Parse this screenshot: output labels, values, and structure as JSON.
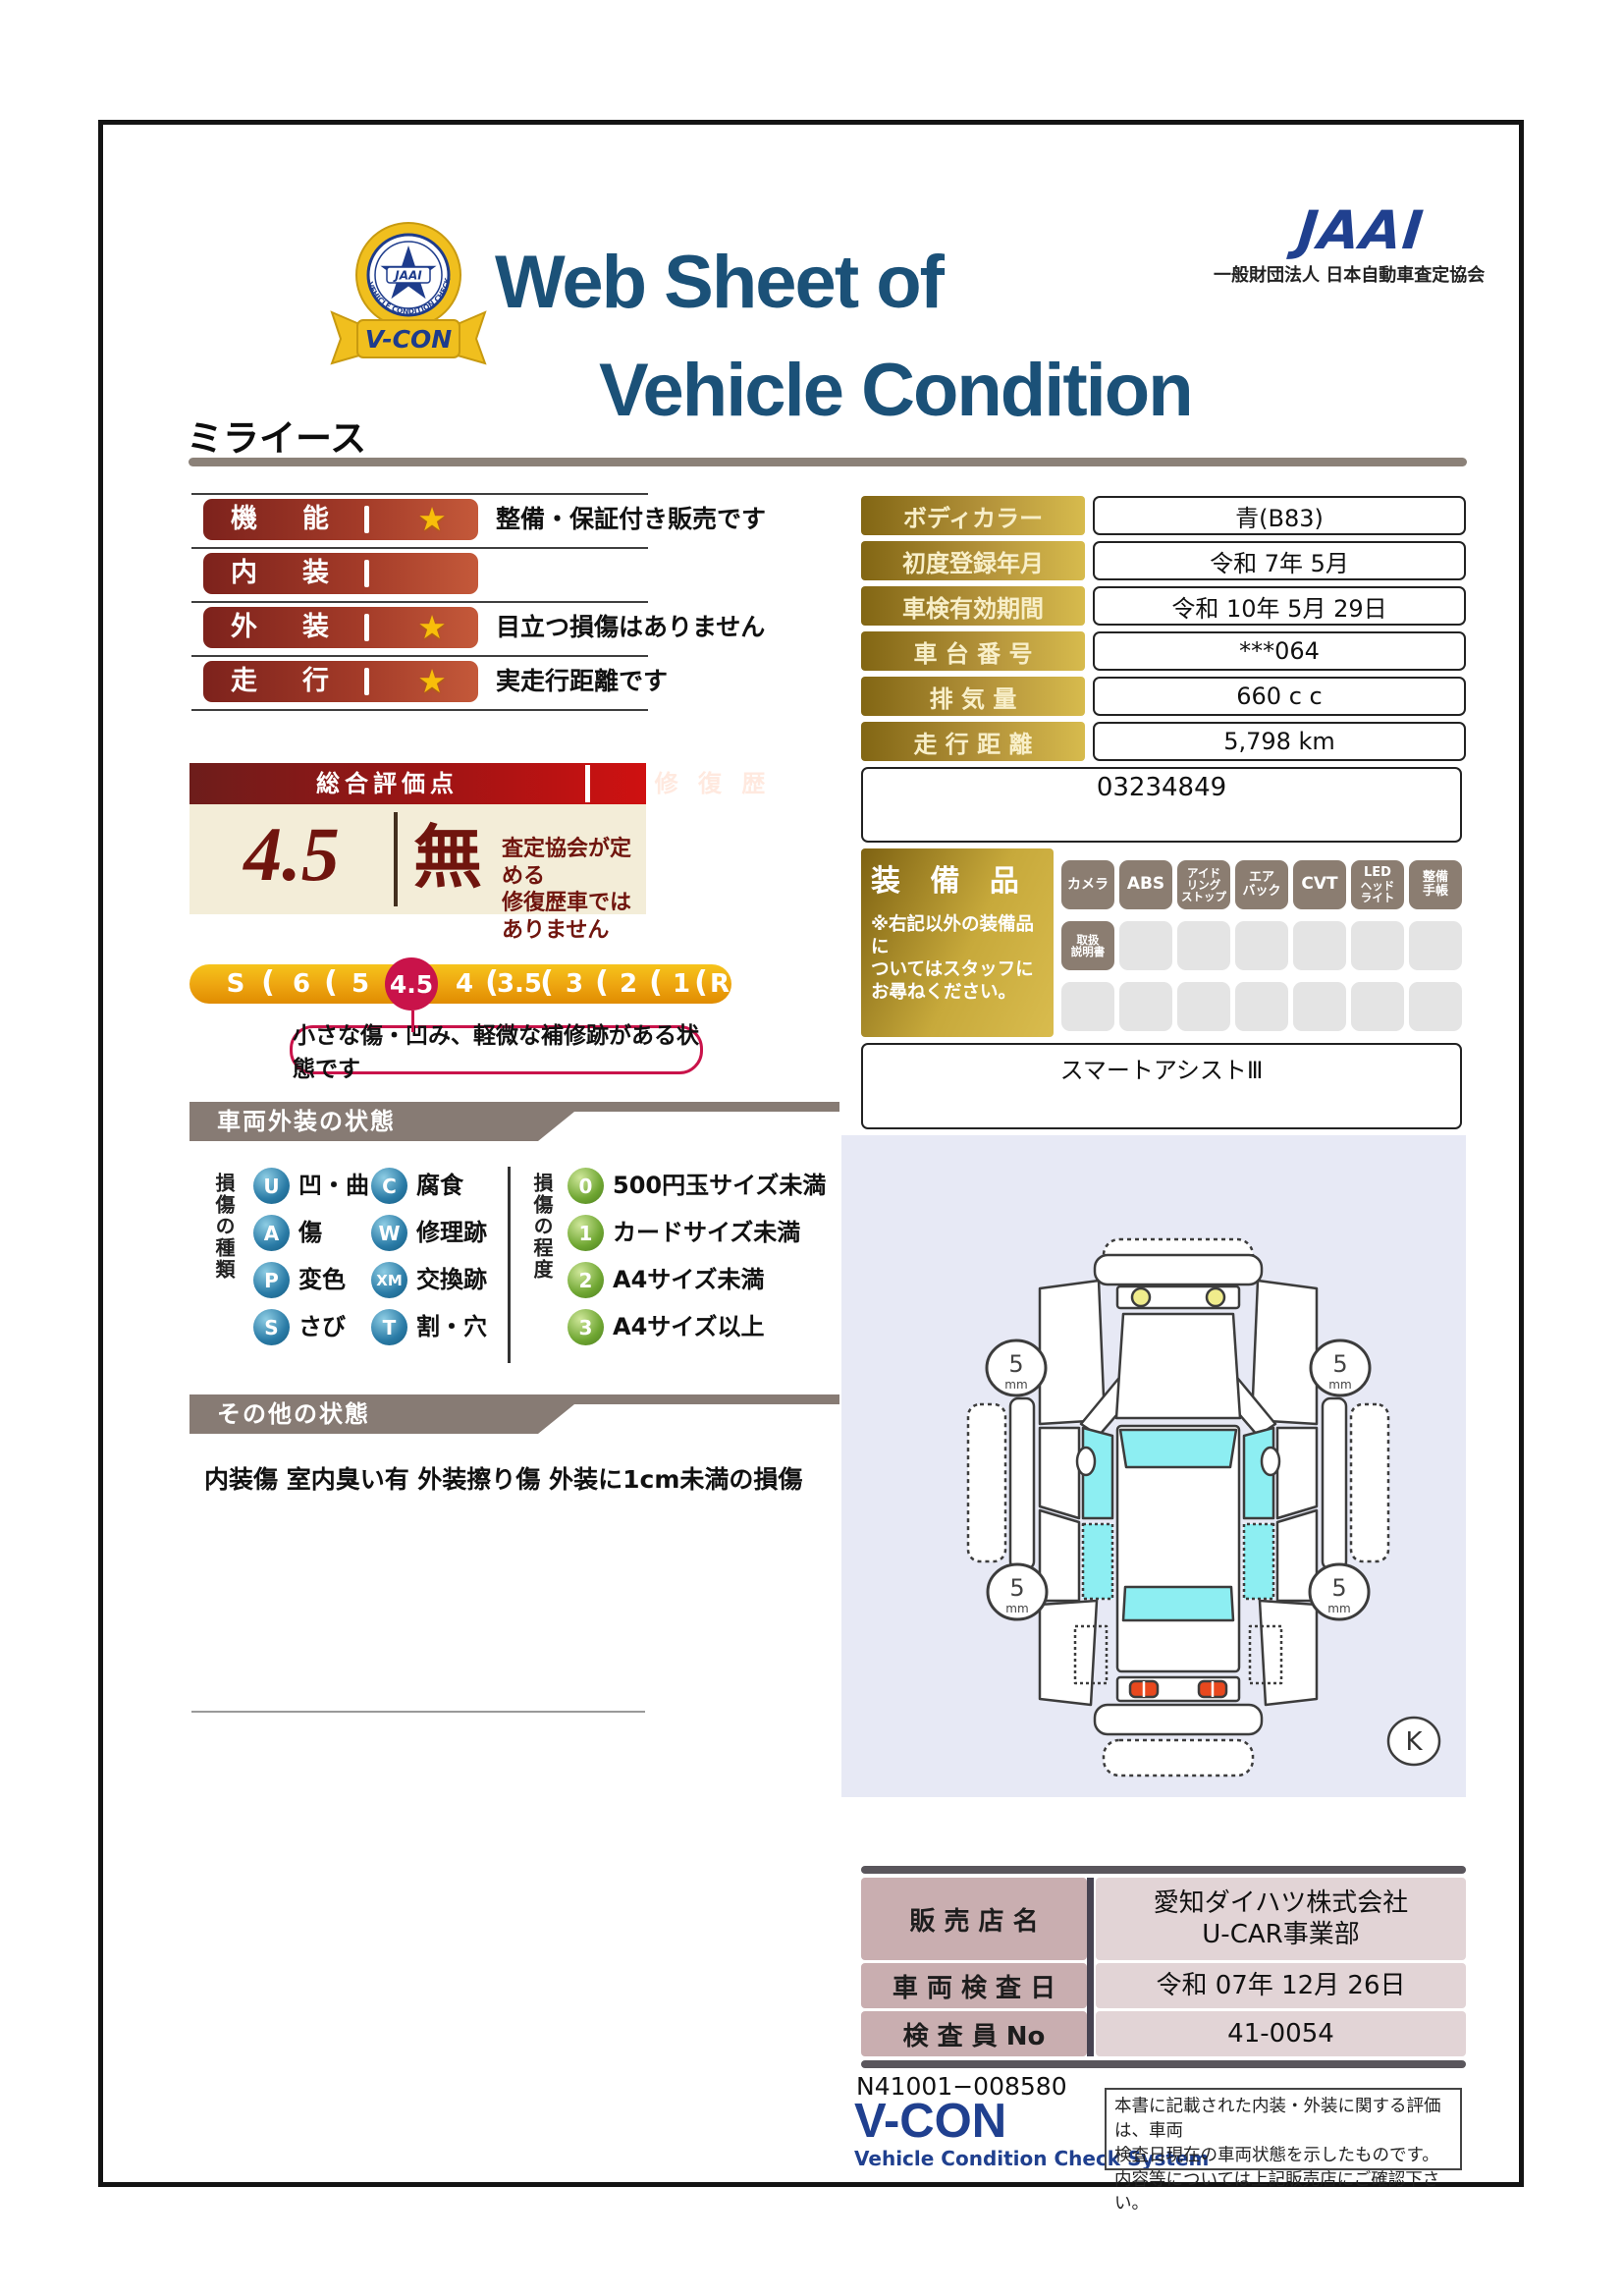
{
  "header": {
    "title_line1": "Web Sheet of",
    "title_line2": "Vehicle Condition",
    "jaai_logo": "JAAI",
    "jaai_org": "一般財団法人 日本自動車査定協会",
    "emblem": {
      "banner": "V-CON",
      "ring_text": "VEHICLE CONDITION CHECK SYSTEM",
      "center": "JAAI"
    }
  },
  "vehicle_name": "ミライース",
  "ratings": {
    "rows": [
      {
        "label": "機能",
        "star": "★",
        "note": "整備・保証付き販売です"
      },
      {
        "label": "内装",
        "star": "",
        "note": ""
      },
      {
        "label": "外装",
        "star": "★",
        "note": "目立つ損傷はありません"
      },
      {
        "label": "走行",
        "star": "★",
        "note": "実走行距離です"
      }
    ]
  },
  "overall": {
    "header_left": "総合評価点",
    "header_right": "修 復 歴",
    "score": "4.5",
    "repair_mark": "無",
    "repair_note1": "査定協会が定める",
    "repair_note2": "修復歴車ではありません",
    "scale": [
      "S",
      "6",
      "5",
      "4.5",
      "4",
      "3.5",
      "3",
      "2",
      "1",
      "R"
    ],
    "selected": "4.5",
    "callout": "小さな傷・凹み、軽微な補修跡がある状態です"
  },
  "info": {
    "rows": [
      {
        "label": "ボディカラー",
        "value": "青(B83)"
      },
      {
        "label": "初度登録年月",
        "value": "令和 7年 5月"
      },
      {
        "label": "車検有効期間",
        "value": "令和 10年 5月 29日"
      },
      {
        "label": "車 台 番 号",
        "value": "***064"
      },
      {
        "label": "排 気 量",
        "value": "660 c c"
      },
      {
        "label": "走 行 距 離",
        "value": "5,798 km"
      }
    ],
    "ref_number": "03234849"
  },
  "equipment": {
    "title": "装 備 品",
    "note1": "※右記以外の装備品に",
    "note2": "ついてはスタッフに",
    "note3": "お尋ねください。",
    "badges": [
      [
        "カメラ"
      ],
      [
        "ABS"
      ],
      [
        "アイド",
        "リング",
        "ストップ"
      ],
      [
        "エア",
        "バック"
      ],
      [
        "CVT"
      ],
      [
        "LED",
        "ヘッド",
        "ライト"
      ],
      [
        "整備",
        "手帳"
      ],
      [
        "取扱",
        "説明書"
      ]
    ],
    "smart_assist": "スマートアシストⅢ"
  },
  "exterior": {
    "section_title": "車両外装の状態",
    "types_title": "損傷の種類",
    "types": [
      [
        "U",
        "凹・曲"
      ],
      [
        "A",
        "傷"
      ],
      [
        "P",
        "変色"
      ],
      [
        "S",
        "さび"
      ],
      [
        "C",
        "腐食"
      ],
      [
        "W",
        "修理跡"
      ],
      [
        "XM",
        "交換跡"
      ],
      [
        "T",
        "割・穴"
      ]
    ],
    "degrees_title": "損傷の程度",
    "degrees": [
      [
        "0",
        "500円玉サイズ未満"
      ],
      [
        "1",
        "カードサイズ未満"
      ],
      [
        "2",
        "A4サイズ未満"
      ],
      [
        "3",
        "A4サイズ以上"
      ]
    ]
  },
  "other": {
    "section_title": "その他の状態",
    "text": "内装傷 室内臭い有 外装擦り傷 外装に1cm未満の損傷"
  },
  "diagram": {
    "tires": [
      "5",
      "5",
      "5",
      "5"
    ],
    "tire_unit": "mm",
    "key_label": "K"
  },
  "dealer": {
    "rows": [
      {
        "label": "販 売 店 名",
        "value1": "愛知ダイハツ株式会社",
        "value2": "U-CAR事業部"
      },
      {
        "label": "車 両 検 査 日",
        "value1": "令和 07年 12月 26日",
        "value2": ""
      },
      {
        "label": "検 査 員 No",
        "value1": "41-0054",
        "value2": ""
      }
    ]
  },
  "footer": {
    "doc_number": "N41001−008580",
    "brand": "V-CON",
    "brand_sub": "Vehicle Condition Check System",
    "disclaimer1": "本書に記載された内装・外装に関する評価は、車両",
    "disclaimer2": "検査日現在の車両状態を示したものです。",
    "disclaimer3": "内容等については上記販売店にご確認下さい。"
  },
  "colors": {
    "accent_navy": "#1b5178",
    "jaai_blue": "#20408f",
    "bar_red_dark": "#7d221c",
    "bar_red_light": "#c4593a",
    "gold_dark": "#826614",
    "gold_light": "#d7bb4d",
    "crimson": "#c9134a",
    "cream": "#f3edd8",
    "section_gray": "#877b74",
    "badge_taupe": "#8b7d71",
    "panel_lavender": "#e7e9f5",
    "maroon_text": "#70150e"
  }
}
